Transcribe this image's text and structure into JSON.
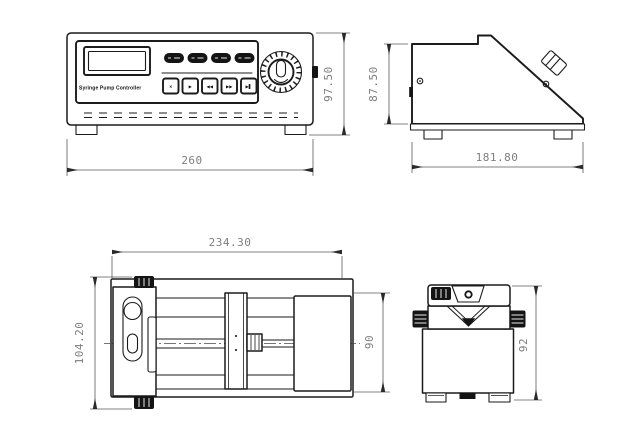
{
  "drawing_title": "Syringe pump dimensional drawing",
  "colors": {
    "line": "#1b1b1b",
    "dim_line": "#5a5a5a",
    "dim_text": "#7e7e7e",
    "solid_fill": "#141414"
  },
  "views": {
    "controller_front": {
      "name": "controller front view",
      "panel_label": "Syringe Pump Controller",
      "key_glyphs": [
        "×",
        "▶",
        "◀◀",
        "▶▶",
        "▶▌"
      ],
      "dim_width": "260",
      "dim_height": "97.50"
    },
    "controller_side": {
      "name": "controller side view",
      "dim_depth": "181.80",
      "dim_height": "87.50"
    },
    "pump_top": {
      "name": "pump unit top view",
      "dim_length": "234.30",
      "dim_overall_width": "104.20",
      "dim_body_width": "90"
    },
    "pump_end": {
      "name": "pump unit end view",
      "dim_height": "92"
    }
  }
}
